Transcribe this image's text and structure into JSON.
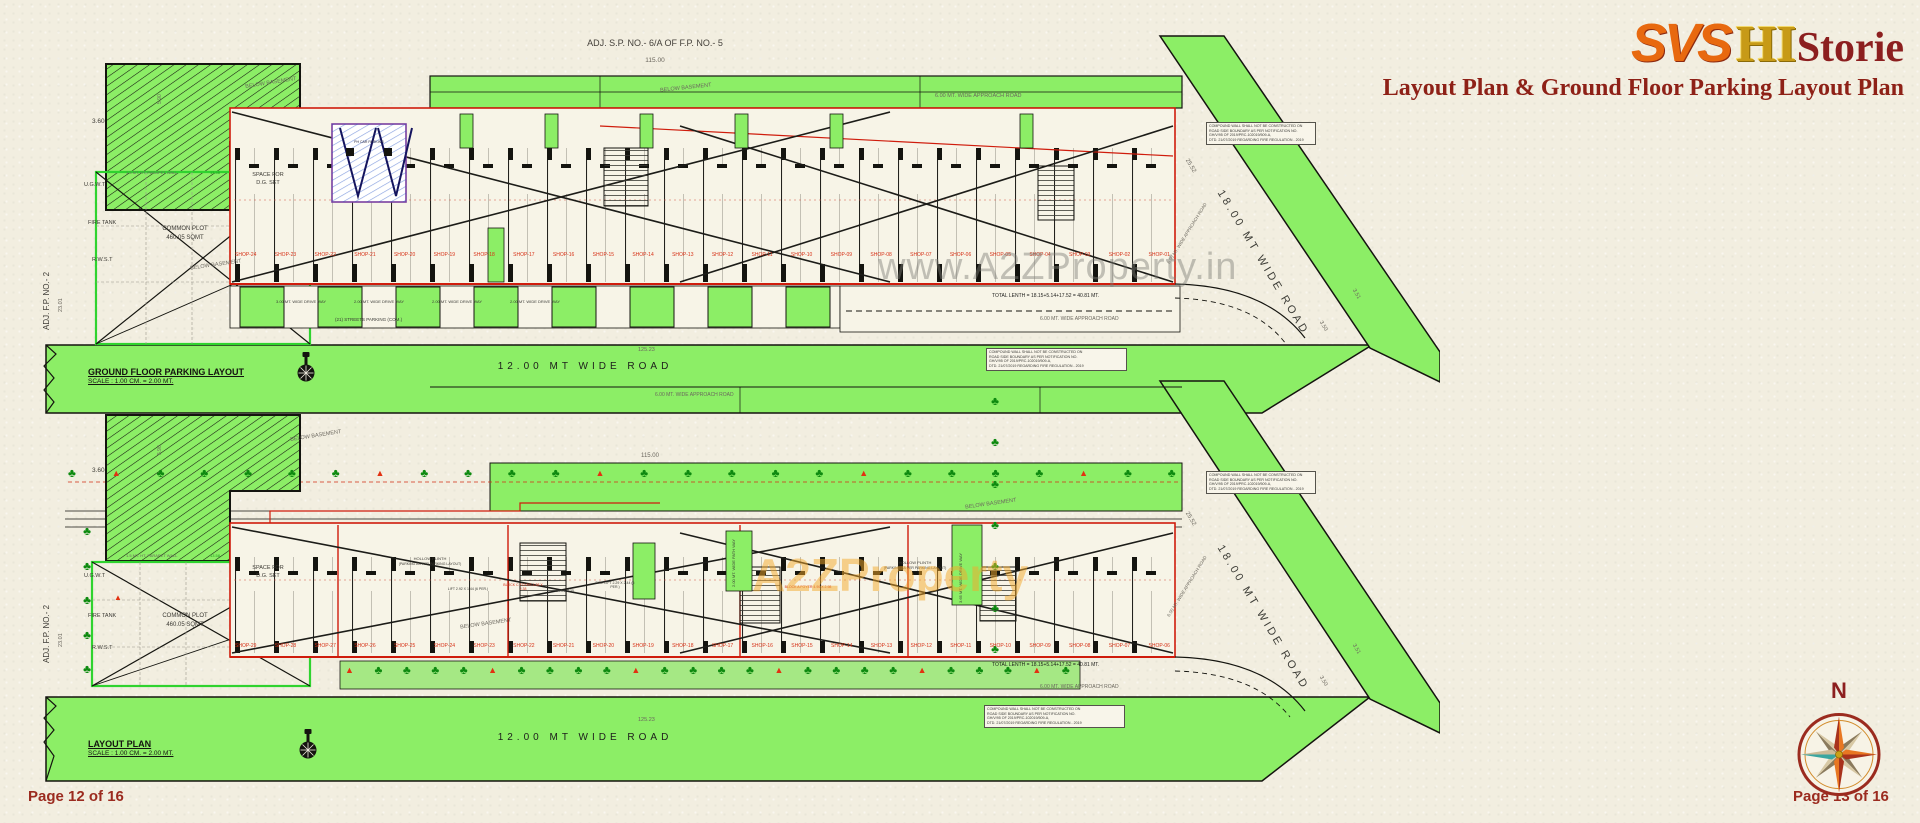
{
  "header": {
    "logo_svs": "SVS",
    "logo_hi": "HI",
    "logo_storie": "Storie",
    "subtitle": "Layout Plan & Ground Floor Parking Layout Plan"
  },
  "watermark_top": "www.A2ZProperty.in",
  "watermark_bottom": "A2ZProperty",
  "footer": {
    "page_left": "Page 12 of 16",
    "page_right": "Page 13 of 16",
    "north": "N"
  },
  "glyphs": {
    "warn": "▲"
  },
  "notes": [
    "COMPOUND WALL SHALL NOT BE CONSTRUCTED ON",
    "ROAD SIDE BOUNDARY AS PER NOTIFICATION NO.",
    "GH/V/95 OF 2019/PRC-102019/509-A,",
    "DTD. 21/07/2019 REGARDING FIRE REGULATION - 2019"
  ],
  "colors": {
    "road_green": "#8cee66",
    "line_red": "#cf1c0c",
    "accent_maroon": "#8c1f1f",
    "logo_orange": "#e8690f",
    "logo_gold": "#c79a17",
    "tree_green": "#0e8a10",
    "plot_green": "#2fd32f"
  },
  "plans": [
    {
      "title": "GROUND FLOOR PARKING LAYOUT",
      "scale": "SCALE : 1.00 CM. = 2.00 MT.",
      "adj_top": "ADJ. S.P. NO.- 6/A OF F.P. NO.- 5",
      "dim_top": "115.00",
      "dim_bottom": "125.23",
      "bottom_road": "12.00 MT WIDE ROAD",
      "right_road": "18.00 MT WIDE ROAD",
      "approach_road": "6.00 MT. WIDE APPROACH ROAD",
      "adj_left": "ADJ. F.P. NO.- 2",
      "dim_left": "23.01",
      "dim_left_top": "3.60",
      "dim_arm": "5.90",
      "dim_right": "25.52",
      "dim_corner_a": "3.50",
      "dim_corner_b": "3.51",
      "parapet": "1.5 MT. HT. PARAPET WALL",
      "dim_parapet": "13.58",
      "ugwt": "U.G.W.T",
      "fire_tank": "FIRE TANK",
      "rwst": "R.W.S.T",
      "common_plot": "COMMON PLOT",
      "common_plot_area": "460.05 SQMT",
      "space_for": "SPACE FOR",
      "dg_set": "D.G. SET",
      "below_basement": "BELOW BASEMENT",
      "ph_car": "PH CAR PARKING",
      "total_length": "TOTAL LENTH = 18.15+5.14+17.52 = 40.81 MT.",
      "streets_parking": "(21) STREETS PARKING (COM.)",
      "drive_ways": [
        "3.00 MT. WIDE DRIVE WAY",
        "2.00 MT. WIDE DRIVE WAY",
        "2.00 MT. WIDE DRIVE WAY",
        "2.00 MT. WIDE DRIVE WAY"
      ],
      "shops": [
        "SHOP-24",
        "SHOP-23",
        "SHOP-22",
        "SHOP-21",
        "SHOP-20",
        "SHOP-19",
        "SHOP-18",
        "SHOP-17",
        "SHOP-16",
        "SHOP-15",
        "SHOP-14",
        "SHOP-13",
        "SHOP-12",
        "SHOP-11",
        "SHOP-10",
        "SHOP-09",
        "SHOP-08",
        "SHOP-07",
        "SHOP-06",
        "SHOP-05",
        "SHOP-04",
        "SHOP-03",
        "SHOP-02",
        "SHOP-01"
      ]
    },
    {
      "title": "LAYOUT PLAN",
      "scale": "SCALE : 1.00 CM. = 2.00 MT.",
      "dim_top": "115.00",
      "dim_bottom": "125.23",
      "bottom_road": "12.00 MT WIDE ROAD",
      "right_road": "18.00 MT WIDE ROAD",
      "approach_road": "6.00 MT. WIDE APPROACH ROAD",
      "adj_left": "ADJ. F.P. NO.- 2",
      "dim_left": "23.01",
      "dim_left_top": "3.60",
      "dim_arm": "5.90",
      "dim_right": "25.52",
      "dim_corner_a": "3.50",
      "dim_corner_b": "3.51",
      "parapet": "1.5 MT. HT. PARAPET WALL",
      "dim_parapet": "13.58",
      "ugwt": "U.G.W.T",
      "fire_tank": "FIRE TANK",
      "rwst": "R.W.S.T",
      "common_plot": "COMMON PLOT",
      "common_plot_area": "460.05 SQMT",
      "space_for": "SPACE FOR",
      "dg_set": "D.G. SET",
      "below_basement": "BELOW BASEMENT",
      "total_length": "TOTAL LENTH = 18.15+5.14+17.52 = 40.81 MT.",
      "hollow_plinth": "HOLLOW PLINTH",
      "hollow_plinth_sub": "(PARKING AS PER PARKING LAYOUT)",
      "path_way": "2.00 MT. WIDE PATH WAY",
      "drive_way_v": "3.65 MT. WIDE DRIVE WAY",
      "lift": "LIFT 2.92 X 1.44 (6 PER.)",
      "fire_lift": "FIRE LIFT 2.29 X 2.44 (6 PER.)",
      "block_a": "BLOCK A FOYER 4.90 X 2.98",
      "block_c": "BLOCK C FOYER 4.38 X 2.38",
      "dim_unit": "3.15 X 2.35",
      "shops": [
        "SHOP-29",
        "SHOP-28",
        "SHOP-27",
        "SHOP-26",
        "SHOP-25",
        "SHOP-24",
        "SHOP-23",
        "SHOP-22",
        "SHOP-21",
        "SHOP-20",
        "SHOP-19",
        "SHOP-18",
        "SHOP-17",
        "SHOP-16",
        "SHOP-15",
        "SHOP-14",
        "SHOP-13",
        "SHOP-12",
        "SHOP-11",
        "SHOP-10",
        "SHOP-09",
        "SHOP-08",
        "SHOP-07",
        "SHOP-06"
      ],
      "greenery_top": [
        "♣",
        "▲",
        "♣",
        "♣",
        "♣",
        "♣",
        "♣",
        "▲",
        "♣",
        "♣",
        "♣",
        "♣",
        "▲",
        "♣",
        "♣",
        "♣",
        "♣",
        "♣",
        "▲",
        "♣",
        "♣",
        "♣",
        "♣",
        "▲",
        "♣",
        "♣"
      ],
      "greenery_bottom": [
        "▲",
        "♣",
        "♣",
        "♣",
        "♣",
        "▲",
        "♣",
        "♣",
        "♣",
        "♣",
        "▲",
        "♣",
        "♣",
        "♣",
        "♣",
        "▲",
        "♣",
        "♣",
        "♣",
        "♣",
        "▲",
        "♣",
        "♣",
        "♣",
        "▲",
        "♣"
      ],
      "greenery_left": [
        "♣",
        "♣",
        "♣",
        "♣",
        "♣"
      ],
      "greenery_right": [
        "♣",
        "♣",
        "♣",
        "♣",
        "♣",
        "♣",
        "♣"
      ]
    }
  ]
}
